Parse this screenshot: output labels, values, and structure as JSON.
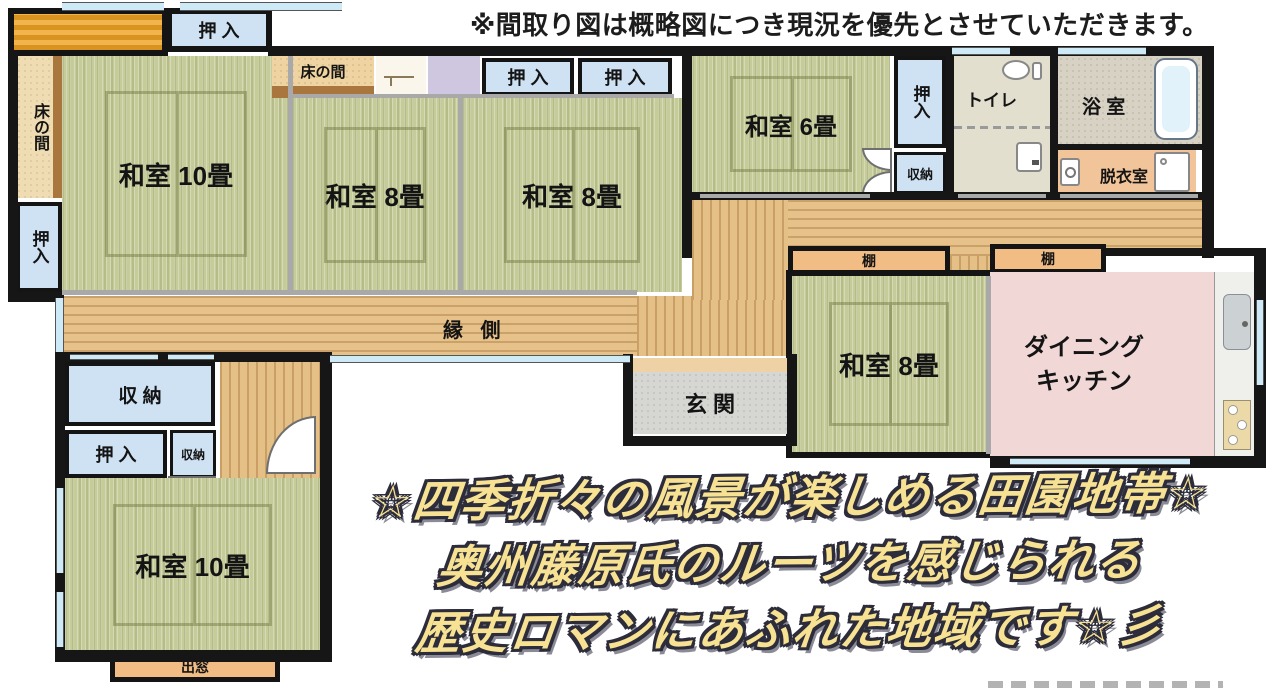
{
  "header": {
    "disclaimer": "※間取り図は概略図につき現況を優先とさせていただきます。"
  },
  "rooms": {
    "oshiire_top": "押 入",
    "tokonoma_left": "床の間",
    "oshiire_left": "押入",
    "washitsu10_a": "和室 10畳",
    "tokonoma_mid": "床の間",
    "oshiire_a": "押 入",
    "oshiire_b": "押 入",
    "washitsu8_a": "和室 8畳",
    "washitsu8_b": "和室 8畳",
    "engawa": "縁 側",
    "washitsu6": "和室 6畳",
    "oshiire_right": "押入",
    "shunou_right": "収納",
    "toilet": "トイレ",
    "bath": "浴 室",
    "datsui": "脱衣室",
    "tana_a": "棚",
    "tana_b": "棚",
    "washitsu8_c": "和室 8畳",
    "dk_line1": "ダイニング",
    "dk_line2": "キッチン",
    "genkan": "玄 関",
    "shunou_bl": "収 納",
    "oshiire_bl": "押 入",
    "shunou_bl_small": "収納",
    "washitsu10_b": "和室 10畳",
    "demado": "出窓"
  },
  "tagline": {
    "line1": "☆四季折々の風景が楽しめる田園地帯☆",
    "line2": "奥州藤原氏のルーツを感じられる",
    "line3": "歴史ロマンにあふれた地域です☆彡"
  },
  "icons": {
    "toilet": "toilet-icon",
    "washbasin": "washbasin-icon",
    "bathtub": "bathtub-icon",
    "washing_machine": "washing-machine-icon",
    "kitchen_sink": "kitchen-sink-icon",
    "stove": "stove-icon",
    "stairs": "stairs-icon",
    "door_arc": "door-arc-icon"
  },
  "colors": {
    "tatami": "#c5cb99",
    "wood": "#e6c28a",
    "closet_blue": "#cfe2f4",
    "shelf_orange": "#f2bd85",
    "dk_pink": "#f2d7d7",
    "datsui_orange": "#f2c49a",
    "genkan_gray": "#d6d6d2",
    "tokonoma_cream": "#efdcb2",
    "lavender": "#cfc7e0",
    "stairs_orange": "#e29a28",
    "wall_black": "#161616",
    "window_blue": "#cdeaf6",
    "tagline_fill": "#f7e193",
    "tagline_outline": "#2c2c3a"
  }
}
